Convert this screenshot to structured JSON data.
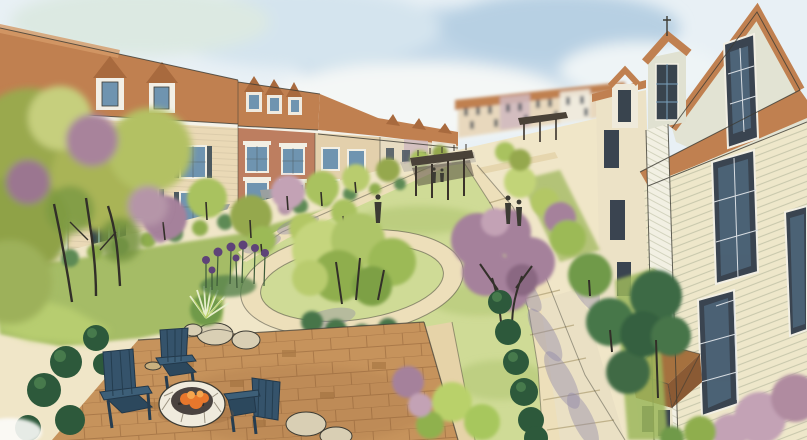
{
  "scene": {
    "title": "Watercolor neighborhood rendering",
    "description": "Hand-drawn watercolor and ink architectural rendering of a townhouse neighborhood. Rows of three-story townhomes with gabled dormers and terracotta roofs line a long central green mall with an oval loop path and street trees in green and plum. Pedestrians walk the side paths, a dark wood trellis pergola spans the walk in the middle distance, and a large gabled building with pale siding and tall dark windows frames the right edge. In the foreground a brick paver patio holds three blue Adirondack chairs around a round stone fire pit with an orange fire, surrounded by clipped evergreen shrubs, boulders, ornamental grasses and purple allium blooms.",
    "style": "watercolor and ink sketch, aerial three-quarter perspective",
    "inventory": {
      "left_townhouses": 6,
      "distant_townhouse_blocks": 2,
      "right_foreground_buildings": 2,
      "adirondack_chairs": 3,
      "fire_pits": 1,
      "pergolas": 2,
      "pedestrians": 5,
      "boulders": 5,
      "hedge_shrubs": "rows of clipped evergreen balls",
      "street_trees": "green and plum ornamental trees",
      "flowers": "purple allium cluster",
      "central_feature": "oval lawn with loop path and tree island"
    }
  },
  "palette": {
    "sky_wash": "#e8f0f5",
    "cloud_blue": "#c3d8e8",
    "cloud_deep": "#b7d0e3",
    "roof_terracotta": "#c08050",
    "roof_shadow": "#a86a3e",
    "fascia_white": "#f5f2e8",
    "facade_white": "#edf0ea",
    "facade_cream": "#ead9b6",
    "facade_brick": "#bd7e60",
    "facade_tan": "#e3d0ac",
    "distant_facade": "#e8d8bd",
    "siding_cream": "#eee7ca",
    "siding_sage": "#e2e3d3",
    "window_glass": "#6f94b0",
    "window_dark": "#3a4450",
    "lawn": "#cfdb96",
    "path_tan": "#eddfba",
    "path_warm": "#e6d3a8",
    "sidewalk": "#eae0c4",
    "shadow_violet": "#8d85a8",
    "patio_brick": "#c6935c",
    "chair_blue": "#35536b",
    "firepit_stone": "#f0ebdd",
    "fire_orange": "#e8772c",
    "boulder": "#d9cfb4",
    "shrub_dark": "#2d593b",
    "tree_olive": "#9aa94e",
    "tree_lime": "#c2d478",
    "plum": "#a5819b",
    "plum_light": "#c3a2b5",
    "pergola_wood": "#4a4238",
    "allium_purple": "#5e4378",
    "ink": "#3c3b33"
  }
}
